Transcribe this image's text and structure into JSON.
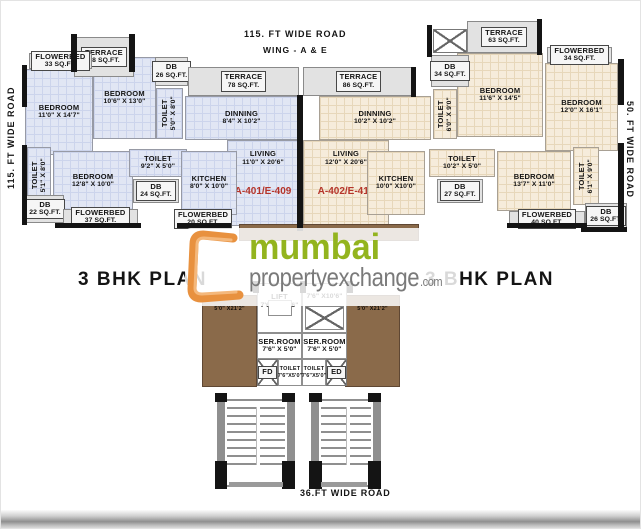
{
  "roads": {
    "top": "115. FT  WIDE  ROAD",
    "wing": "WING - A & E",
    "left": "115. FT  WIDE  ROAD",
    "right": "50. FT  WIDE  ROAD",
    "bottom": "36.FT WIDE ROAD"
  },
  "titles": {
    "left": "3 BHK PLAN",
    "right": "3 BHK PLAN"
  },
  "watermark": {
    "word1": "mumbai",
    "word2": "propertyexchange",
    "suffix": ".com",
    "green": "#93b41e",
    "gray": "#7a7a7a",
    "orange": "#e8913f"
  },
  "units": {
    "color": "#b5342a"
  },
  "rooms": [
    {
      "id": "terrace-58",
      "l1": "TERRACE",
      "l2": "58 SQ.FT."
    },
    {
      "id": "flowerbed-33",
      "l1": "FLOWERBED",
      "l2": "33 SQ.FT."
    },
    {
      "id": "bedroom-a1",
      "l1": "BEDROOM",
      "l2": "11'0\" X 14'7\""
    },
    {
      "id": "bedroom-a2",
      "l1": "BEDROOM",
      "l2": "10'6\" X 13'0\""
    },
    {
      "id": "db-26-a",
      "l1": "DB",
      "l2": "26 SQ.FT."
    },
    {
      "id": "toilet-a1",
      "l1": "TOILET",
      "l2": "5'0\" X 8'0\""
    },
    {
      "id": "terrace-78",
      "l1": "TERRACE",
      "l2": "78 SQ.FT."
    },
    {
      "id": "dinning-a",
      "l1": "DINNING",
      "l2": "8'4\" X 10'2\""
    },
    {
      "id": "living-a",
      "l1": "LIVING",
      "l2": "11'0\" X 20'6\"",
      "unit": "A-401/E-409"
    },
    {
      "id": "toilet-a2",
      "l1": "TOILET",
      "l2": "5'1\" X 8'0\""
    },
    {
      "id": "bedroom-a3",
      "l1": "BEDROOM",
      "l2": "12'8\" X 10'0\""
    },
    {
      "id": "toilet-a3",
      "l1": "TOILET",
      "l2": "9'2\" X 5'0\""
    },
    {
      "id": "db-24",
      "l1": "DB",
      "l2": "24 SQ.FT."
    },
    {
      "id": "kitchen-a",
      "l1": "KITCHEN",
      "l2": "8'0\" X 10'0\""
    },
    {
      "id": "db-22",
      "l1": "DB",
      "l2": "22 SQ.FT."
    },
    {
      "id": "flowerbed-37",
      "l1": "FLOWERBED",
      "l2": "37 SQ.FT."
    },
    {
      "id": "flowerbed-20",
      "l1": "FLOWERBED",
      "l2": "20 SQ.FT."
    },
    {
      "id": "terrace-63",
      "l1": "TERRACE",
      "l2": "63 SQ.FT."
    },
    {
      "id": "db-34",
      "l1": "DB",
      "l2": "34 SQ.FT."
    },
    {
      "id": "flowerbed-34",
      "l1": "FLOWERBED",
      "l2": "34 SQ.FT."
    },
    {
      "id": "bedroom-e1",
      "l1": "BEDROOM",
      "l2": "11'6\" X 14'5\""
    },
    {
      "id": "bedroom-e2",
      "l1": "BEDROOM",
      "l2": "12'0\" X 16'1\""
    },
    {
      "id": "toilet-e1",
      "l1": "TOILET",
      "l2": "6'0\" X 9'0\""
    },
    {
      "id": "terrace-86",
      "l1": "TERRACE",
      "l2": "86 SQ.FT."
    },
    {
      "id": "dinning-e",
      "l1": "DINNING",
      "l2": "10'2\" X 10'2\""
    },
    {
      "id": "living-e",
      "l1": "LIVING",
      "l2": "12'0\" X 20'6\"",
      "unit": "A-402/E-410"
    },
    {
      "id": "kitchen-e",
      "l1": "KITCHEN",
      "l2": "10'0\" X10'0\""
    },
    {
      "id": "toilet-e2",
      "l1": "TOILET",
      "l2": "10'2\" X 5'0\""
    },
    {
      "id": "db-27",
      "l1": "DB",
      "l2": "27 SQ.FT."
    },
    {
      "id": "bedroom-e3",
      "l1": "BEDROOM",
      "l2": "13'7\" X 11'0\""
    },
    {
      "id": "toilet-e3",
      "l1": "TOILET",
      "l2": "6'1\" X 9'0\""
    },
    {
      "id": "flowerbed-40",
      "l1": "FLOWERBED",
      "l2": "40 SQ.FT."
    },
    {
      "id": "db-26-e",
      "l1": "DB",
      "l2": "26 SQ.FT."
    },
    {
      "id": "duct-left",
      "l1": "5'0\" X21'2\"",
      "l2": ""
    },
    {
      "id": "duct-right",
      "l1": "5'0\" X21'2\"",
      "l2": ""
    },
    {
      "id": "lift-left",
      "l1": "LIFT",
      "l2": "7'6\" X 10'6\""
    },
    {
      "id": "lift-right",
      "l1": "",
      "l2": "7'6\" X10'6\""
    },
    {
      "id": "serroom-left",
      "l1": "SER.ROOM",
      "l2": "7'6\" X 5'0\""
    },
    {
      "id": "serroom-right",
      "l1": "SER.ROOM",
      "l2": "7'6\" X 5'0\""
    },
    {
      "id": "fd",
      "l1": "FD",
      "l2": ""
    },
    {
      "id": "toilet-sm-left",
      "l1": "TOILET",
      "l2": "7'6\"X5'0\""
    },
    {
      "id": "toilet-sm-right",
      "l1": "TOILET",
      "l2": "7'6\"X5'0\""
    },
    {
      "id": "ed",
      "l1": "ED",
      "l2": ""
    }
  ]
}
